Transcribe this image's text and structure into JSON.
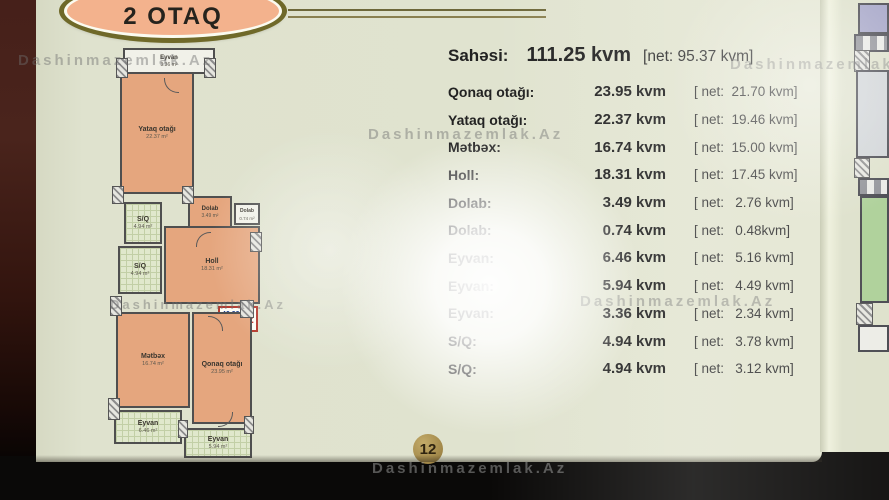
{
  "watermark": "Dashinmazemlak.Az",
  "header": {
    "title": "2 OTAQ"
  },
  "summary": {
    "label": "Sahəsi:",
    "value": "111.25 kvm",
    "net": "[net: 95.37 kvm]"
  },
  "table": {
    "rows": [
      {
        "label": "Qonaq otağı:",
        "area": "23.95 kvm",
        "net": "[ net:  21.70 kvm]"
      },
      {
        "label": "Yataq otağı:",
        "area": "22.37 kvm",
        "net": "[ net:  19.46 kvm]"
      },
      {
        "label": "Mətbəx:",
        "area": "16.74 kvm",
        "net": "[ net:  15.00 kvm]"
      },
      {
        "label": "Holl:",
        "area": "18.31 kvm",
        "net": "[ net:  17.45 kvm]"
      },
      {
        "label": "Dolab:",
        "area": "3.49 kvm",
        "net": "[ net:   2.76 kvm]"
      },
      {
        "label": "Dolab:",
        "area": "0.74 kvm",
        "net": "[ net:   0.48kvm]"
      },
      {
        "label": "Eyvan:",
        "area": "6.46 kvm",
        "net": "[ net:   5.16 kvm]"
      },
      {
        "label": "Eyvan:",
        "area": "5.94 kvm",
        "net": "[ net:   4.49 kvm]"
      },
      {
        "label": "Eyvan:",
        "area": "3.36 kvm",
        "net": "[ net:   2.34 kvm]"
      },
      {
        "label": "S/Q:",
        "area": "4.94 kvm",
        "net": "[ net:   3.78 kvm]"
      },
      {
        "label": "S/Q:",
        "area": "4.94 kvm",
        "net": "[ net:   3.12 kvm]"
      }
    ]
  },
  "floorplan": {
    "rooms": [
      {
        "name": "Eyvan",
        "area": "3.36 m²"
      },
      {
        "name": "Yataq otağı",
        "area": "22.37 m²"
      },
      {
        "name": "S/Q",
        "area": "4.94 m²"
      },
      {
        "name": "S/Q",
        "area": "4.94 m²"
      },
      {
        "name": "Dolab",
        "area": "3.49 m²"
      },
      {
        "name": "Dolab",
        "area": "0.74 m²"
      },
      {
        "name": "Holl",
        "area": "18.31 m²"
      },
      {
        "name": "Mətbəx",
        "area": "16.74 m²"
      },
      {
        "name": "Qonaq otağı",
        "area": "23.95 m²"
      },
      {
        "name": "Eyvan",
        "area": "6.46 m²"
      },
      {
        "name": "Eyvan",
        "area": "5.94 m²"
      }
    ],
    "stamp": {
      "line1": "46.32",
      "line2": "111.25",
      "rooms": "2"
    }
  },
  "footer": {
    "page_number": "12"
  },
  "colors": {
    "accent_salmon": "#e5a67e",
    "badge_border": "#6f6929",
    "stamp_red": "#c03028",
    "stamp_blue": "#1f3e8e",
    "page_bg": "#e0e3cf"
  }
}
